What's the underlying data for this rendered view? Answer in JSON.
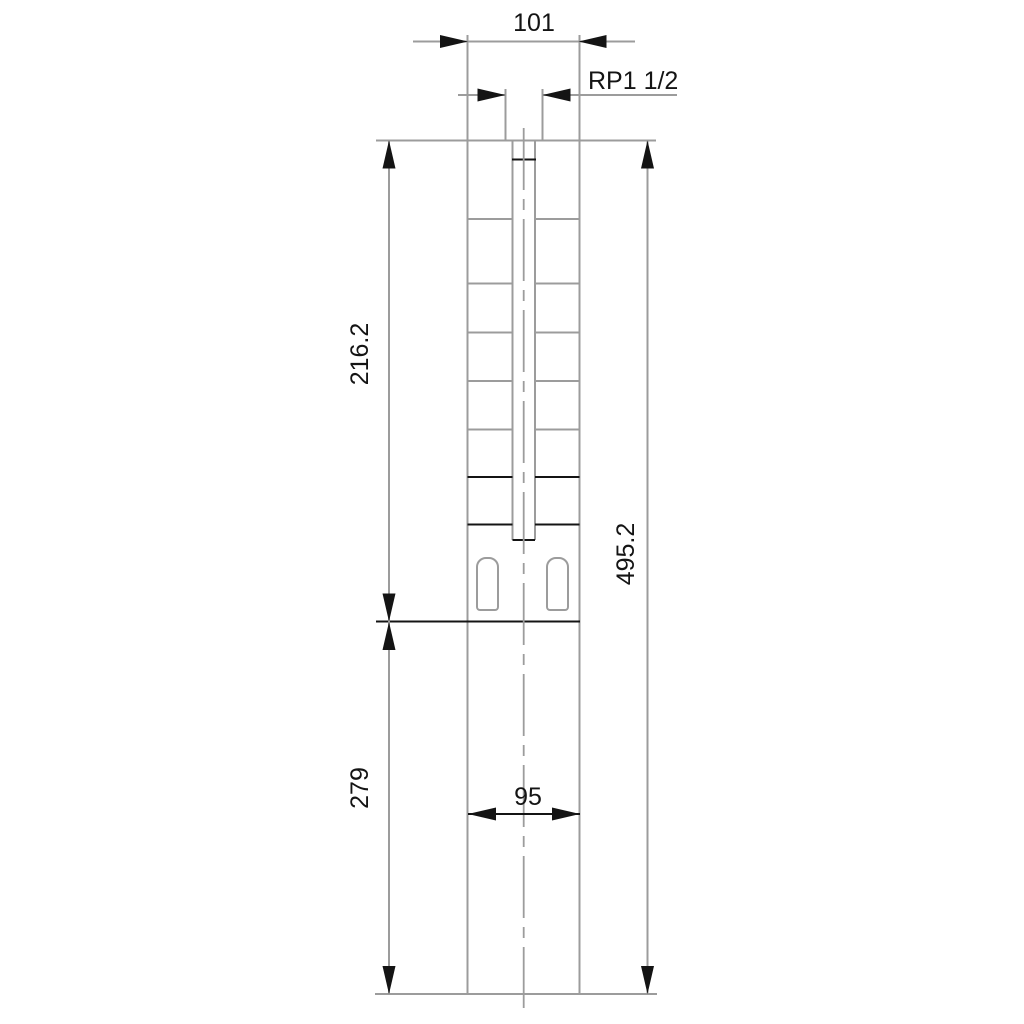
{
  "drawing": {
    "type": "technical-dimension-drawing",
    "subject": "submersible pump outline with dimensions",
    "labels": {
      "width_top": "101",
      "thread": "RP1 1/2",
      "pump_section_height": "216.2",
      "overall_height": "495.2",
      "motor_section_height": "279",
      "width_bottom": "95"
    },
    "features": {
      "stage_lines": 7,
      "cable_slots": 2
    },
    "colors": {
      "outline_gray": "#9c9c9c",
      "detail_black": "#141414",
      "background": "#ffffff"
    }
  }
}
